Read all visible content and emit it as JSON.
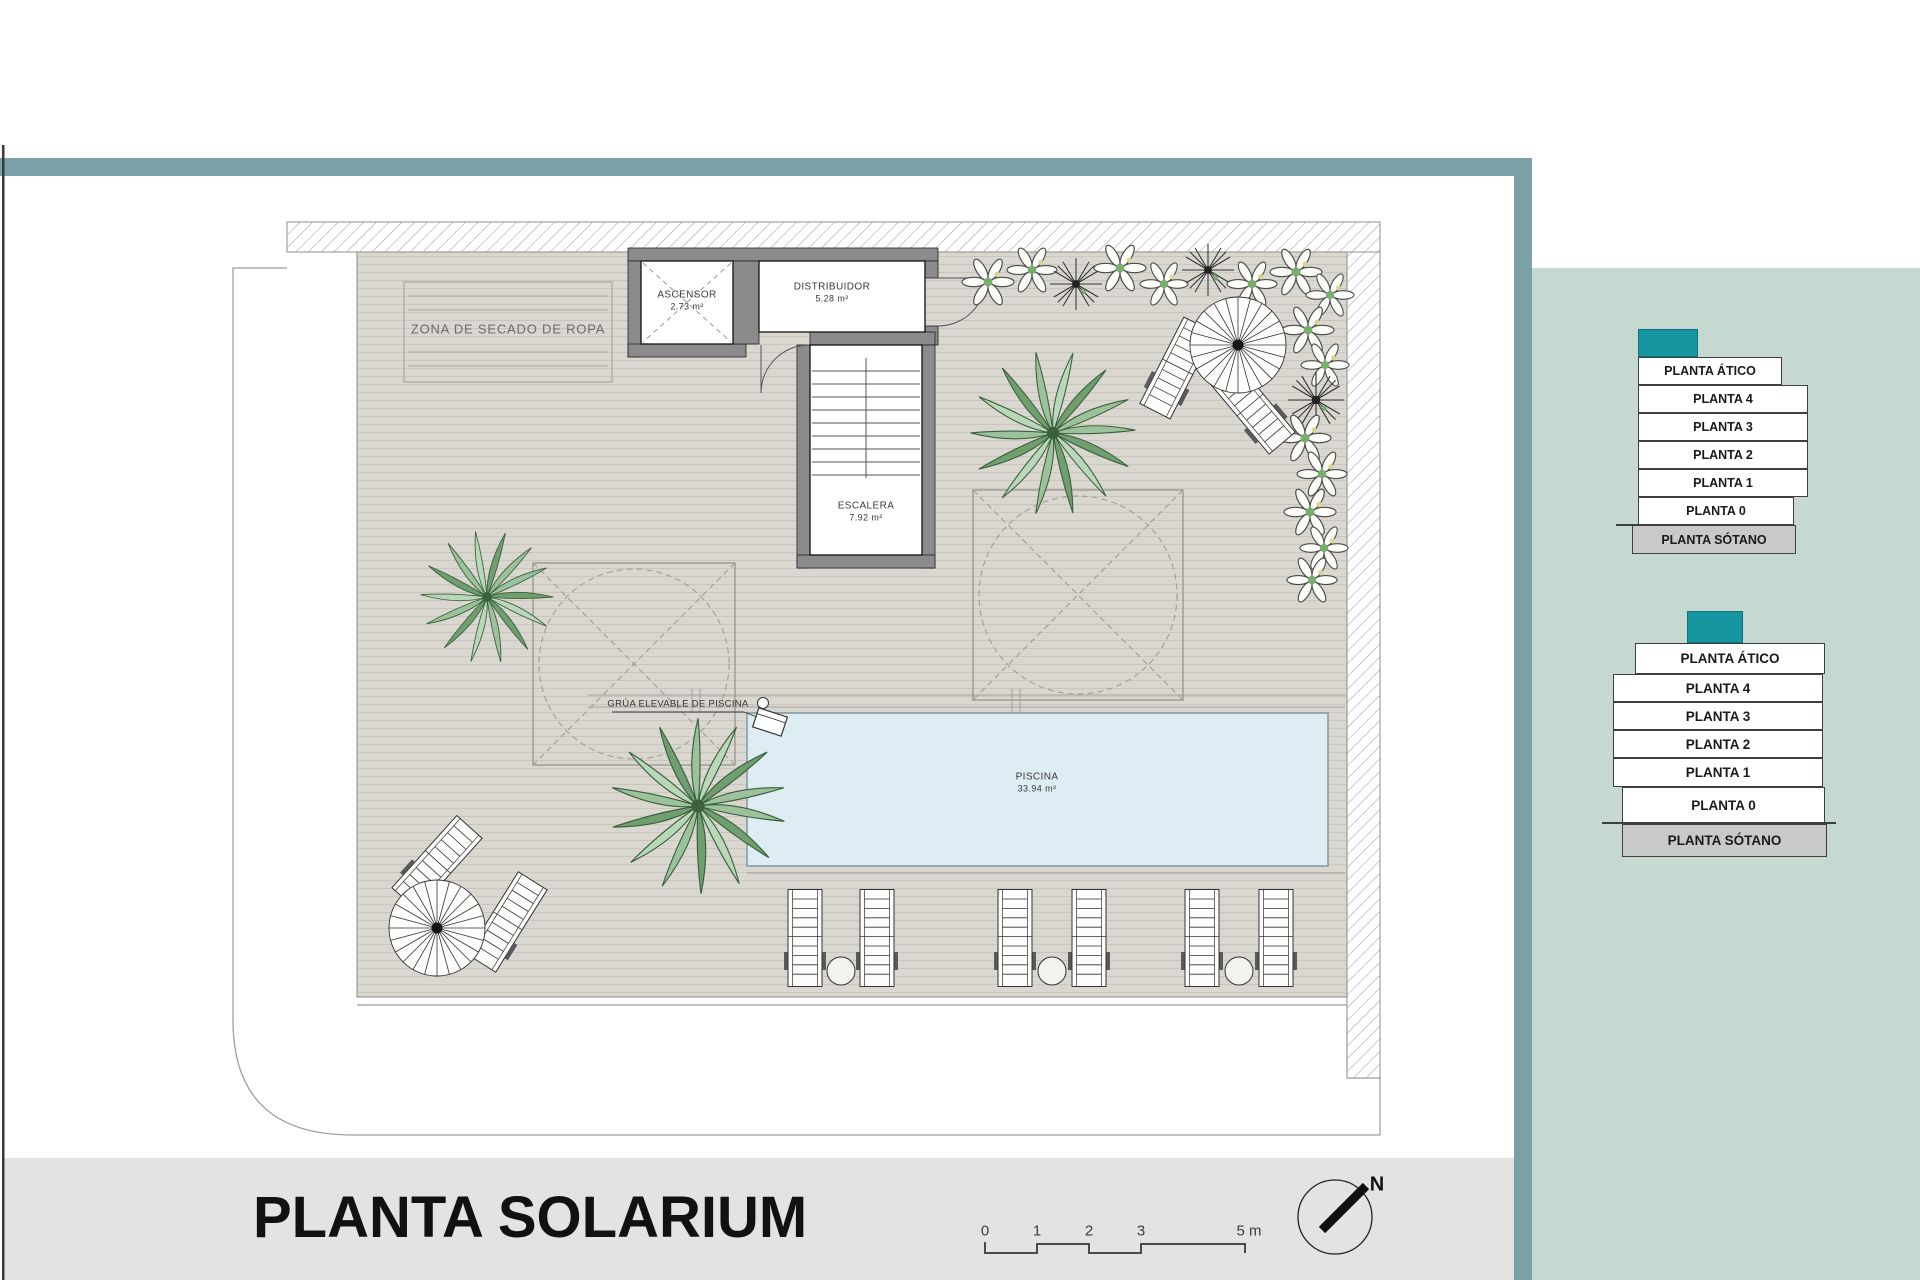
{
  "title": {
    "text": "PLANTA SOLARIUM"
  },
  "plan": {
    "zona_secado_label": "ZONA DE SECADO DE ROPA",
    "grua_label": "GRÚA ELEVABLE DE PISCINA",
    "rooms": {
      "ascensor": {
        "name": "ASCENSOR",
        "area": "2.73 m²"
      },
      "distribuidor": {
        "name": "DISTRIBUIDOR",
        "area": "5.28 m²"
      },
      "escalera": {
        "name": "ESCALERA",
        "area": "7.92 m²"
      },
      "piscina": {
        "name": "PISCINA",
        "area": "33.94 m²"
      }
    }
  },
  "scale_bar": {
    "labels": [
      "0",
      "1",
      "2",
      "3",
      "5 m"
    ]
  },
  "compass": {
    "north_label": "N"
  },
  "legend_stacks": {
    "stack_top": {
      "levels": [
        "PLANTA ÁTICO",
        "PLANTA 4",
        "PLANTA 3",
        "PLANTA 2",
        "PLANTA 1",
        "PLANTA 0",
        "PLANTA SÓTANO"
      ]
    },
    "stack_bottom": {
      "levels": [
        "PLANTA ÁTICO",
        "PLANTA 4",
        "PLANTA 3",
        "PLANTA 2",
        "PLANTA 1",
        "PLANTA 0",
        "PLANTA SÓTANO"
      ]
    }
  },
  "colors": {
    "frame_teal": "#7aa0a8",
    "panel_sage": "#c6d9d0",
    "accent_teal": "#1596a0",
    "bottom_band_gray": "#e3e3e2",
    "deck_tan": "#d9d7cf",
    "pool_blue": "#ddedf3",
    "wall_gray": "#8b8b8b"
  }
}
